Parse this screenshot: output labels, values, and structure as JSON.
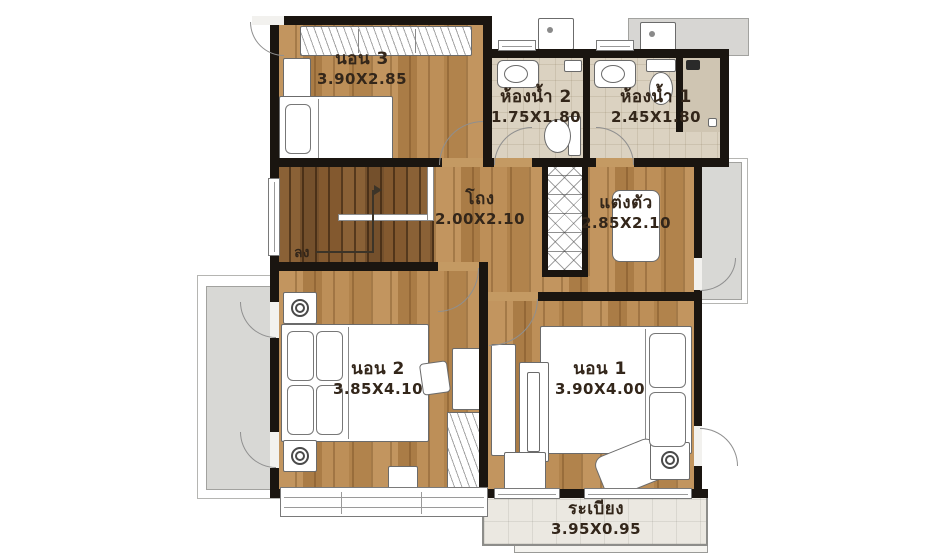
{
  "plan": {
    "rooms": [
      {
        "id": "bedroom-3",
        "name": "นอน 3",
        "dim": "3.90X2.85"
      },
      {
        "id": "bathroom-2",
        "name": "ห้องน้ำ 2",
        "dim": "1.75X1.80"
      },
      {
        "id": "bathroom-1",
        "name": "ห้องน้ำ 1",
        "dim": "2.45X1.80"
      },
      {
        "id": "hall",
        "name": "โถง",
        "dim": "2.00X2.10"
      },
      {
        "id": "dressing",
        "name": "แต่งตัว",
        "dim": "2.85X2.10"
      },
      {
        "id": "bedroom-2",
        "name": "นอน 2",
        "dim": "3.85X4.10"
      },
      {
        "id": "bedroom-1",
        "name": "นอน 1",
        "dim": "3.90X4.00"
      },
      {
        "id": "balcony",
        "name": "ระเบียง",
        "dim": "3.95X0.95"
      }
    ],
    "stairs_label": "ลง",
    "colors": {
      "wall": "#1a1510",
      "wood_floor": "#b5854e",
      "stair_wood": "#7f5731",
      "bath_tile": "#dbd2c1",
      "balcony_tile": "#ebe8e1",
      "terrace_concrete": "#d8d8d5",
      "label_text": "#33261a"
    }
  }
}
